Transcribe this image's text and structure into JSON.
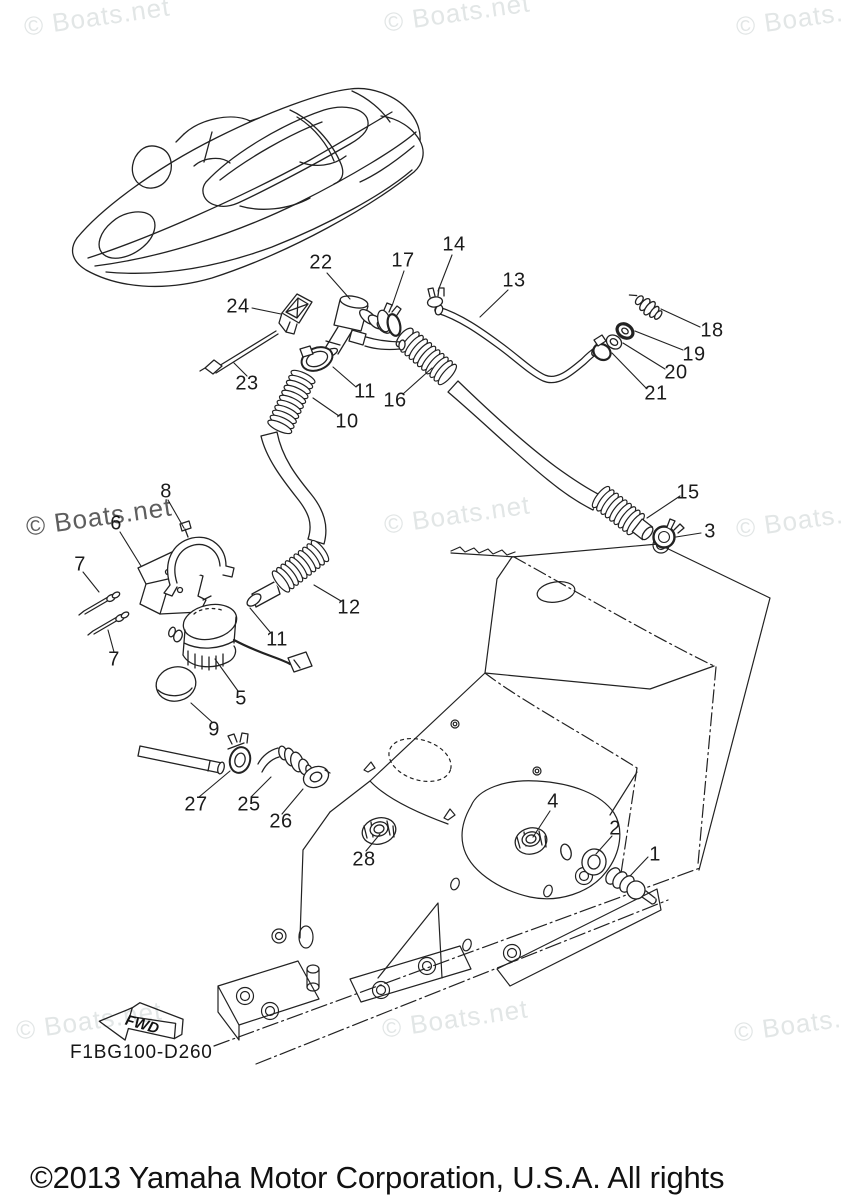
{
  "watermark": {
    "text": "© Boats.net",
    "light_color": "#e2e6e6",
    "dark_color": "#5e5e5e",
    "positions": [
      {
        "x": 22,
        "y": 12,
        "tone": "light"
      },
      {
        "x": 382,
        "y": 8,
        "tone": "light"
      },
      {
        "x": 734,
        "y": 12,
        "tone": "light"
      },
      {
        "x": 24,
        "y": 512,
        "tone": "dark"
      },
      {
        "x": 382,
        "y": 510,
        "tone": "light"
      },
      {
        "x": 734,
        "y": 514,
        "tone": "light"
      },
      {
        "x": 14,
        "y": 1016,
        "tone": "light"
      },
      {
        "x": 380,
        "y": 1014,
        "tone": "light"
      },
      {
        "x": 732,
        "y": 1018,
        "tone": "light"
      }
    ]
  },
  "diagram": {
    "code": "F1BG100-D260",
    "fwd_label": "FWD",
    "callouts": [
      {
        "label": "22",
        "x": 321,
        "y": 263
      },
      {
        "label": "17",
        "x": 403,
        "y": 261
      },
      {
        "label": "14",
        "x": 454,
        "y": 245
      },
      {
        "label": "13",
        "x": 514,
        "y": 281
      },
      {
        "label": "18",
        "x": 712,
        "y": 331
      },
      {
        "label": "19",
        "x": 694,
        "y": 355
      },
      {
        "label": "20",
        "x": 676,
        "y": 373
      },
      {
        "label": "21",
        "x": 656,
        "y": 394
      },
      {
        "label": "24",
        "x": 238,
        "y": 307
      },
      {
        "label": "23",
        "x": 247,
        "y": 384
      },
      {
        "label": "11",
        "x": 365,
        "y": 392
      },
      {
        "label": "10",
        "x": 347,
        "y": 422
      },
      {
        "label": "16",
        "x": 395,
        "y": 401
      },
      {
        "label": "15",
        "x": 688,
        "y": 493
      },
      {
        "label": "3",
        "x": 710,
        "y": 532
      },
      {
        "label": "8",
        "x": 166,
        "y": 492
      },
      {
        "label": "6",
        "x": 116,
        "y": 524
      },
      {
        "label": "7",
        "x": 80,
        "y": 565
      },
      {
        "label": "7",
        "x": 114,
        "y": 660
      },
      {
        "label": "5",
        "x": 241,
        "y": 699
      },
      {
        "label": "9",
        "x": 214,
        "y": 730
      },
      {
        "label": "12",
        "x": 349,
        "y": 608
      },
      {
        "label": "11",
        "x": 277,
        "y": 640
      },
      {
        "label": "27",
        "x": 196,
        "y": 805
      },
      {
        "label": "25",
        "x": 249,
        "y": 805
      },
      {
        "label": "26",
        "x": 281,
        "y": 822
      },
      {
        "label": "28",
        "x": 364,
        "y": 860
      },
      {
        "label": "4",
        "x": 553,
        "y": 802
      },
      {
        "label": "2",
        "x": 615,
        "y": 829
      },
      {
        "label": "1",
        "x": 655,
        "y": 855
      }
    ]
  },
  "footer": {
    "copyright": "©2013 Yamaha Motor Corporation, U.S.A. All rights reserved."
  }
}
